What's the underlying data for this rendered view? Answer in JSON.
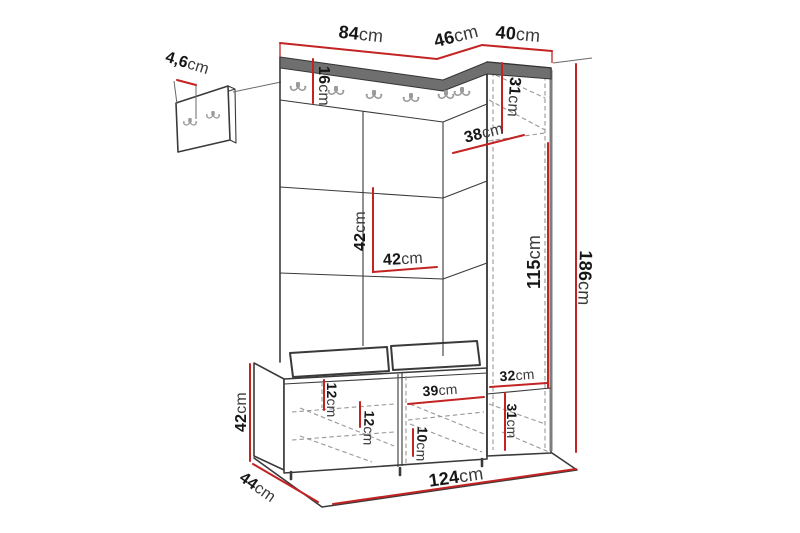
{
  "diagram": {
    "type": "furniture-dimension-diagram",
    "subject": "hallway storage unit with coat hooks, bench and tall cabinet",
    "unit_of_measure": "cm",
    "colors": {
      "dimension_line": "#c32323",
      "outline": "#3a3a3a",
      "hidden_line": "#989898",
      "top_band": "#6f6f6f",
      "hook": "#9a9a9a",
      "background": "#ffffff"
    },
    "hooks": {
      "wall_hook_count": 6,
      "small_panel_hook_count": 2
    },
    "dimensions": {
      "panel_depth": {
        "value": "4,6",
        "unit": "cm"
      },
      "total_top_front": {
        "value": "84",
        "unit": "cm"
      },
      "top_corner": {
        "value": "46",
        "unit": "cm"
      },
      "cabinet_top": {
        "value": "40",
        "unit": "cm"
      },
      "hook_rail_height": {
        "value": "16",
        "unit": "cm"
      },
      "cabinet_upper": {
        "value": "31",
        "unit": "cm"
      },
      "cabinet_depth": {
        "value": "38",
        "unit": "cm"
      },
      "panel_square_h": {
        "value": "42",
        "unit": "cm"
      },
      "panel_square_w": {
        "value": "42",
        "unit": "cm"
      },
      "door_height": {
        "value": "115",
        "unit": "cm"
      },
      "total_height": {
        "value": "186",
        "unit": "cm"
      },
      "cabinet_inner_w": {
        "value": "32",
        "unit": "cm"
      },
      "cabinet_lower": {
        "value": "31",
        "unit": "cm"
      },
      "bench_top": {
        "value": "12",
        "unit": "cm"
      },
      "bench_inner": {
        "value": "12",
        "unit": "cm"
      },
      "bench_opening": {
        "value": "39",
        "unit": "cm"
      },
      "bench_shelf": {
        "value": "10",
        "unit": "cm"
      },
      "bench_height": {
        "value": "42",
        "unit": "cm"
      },
      "bench_depth": {
        "value": "44",
        "unit": "cm"
      },
      "total_width": {
        "value": "124",
        "unit": "cm"
      }
    }
  }
}
